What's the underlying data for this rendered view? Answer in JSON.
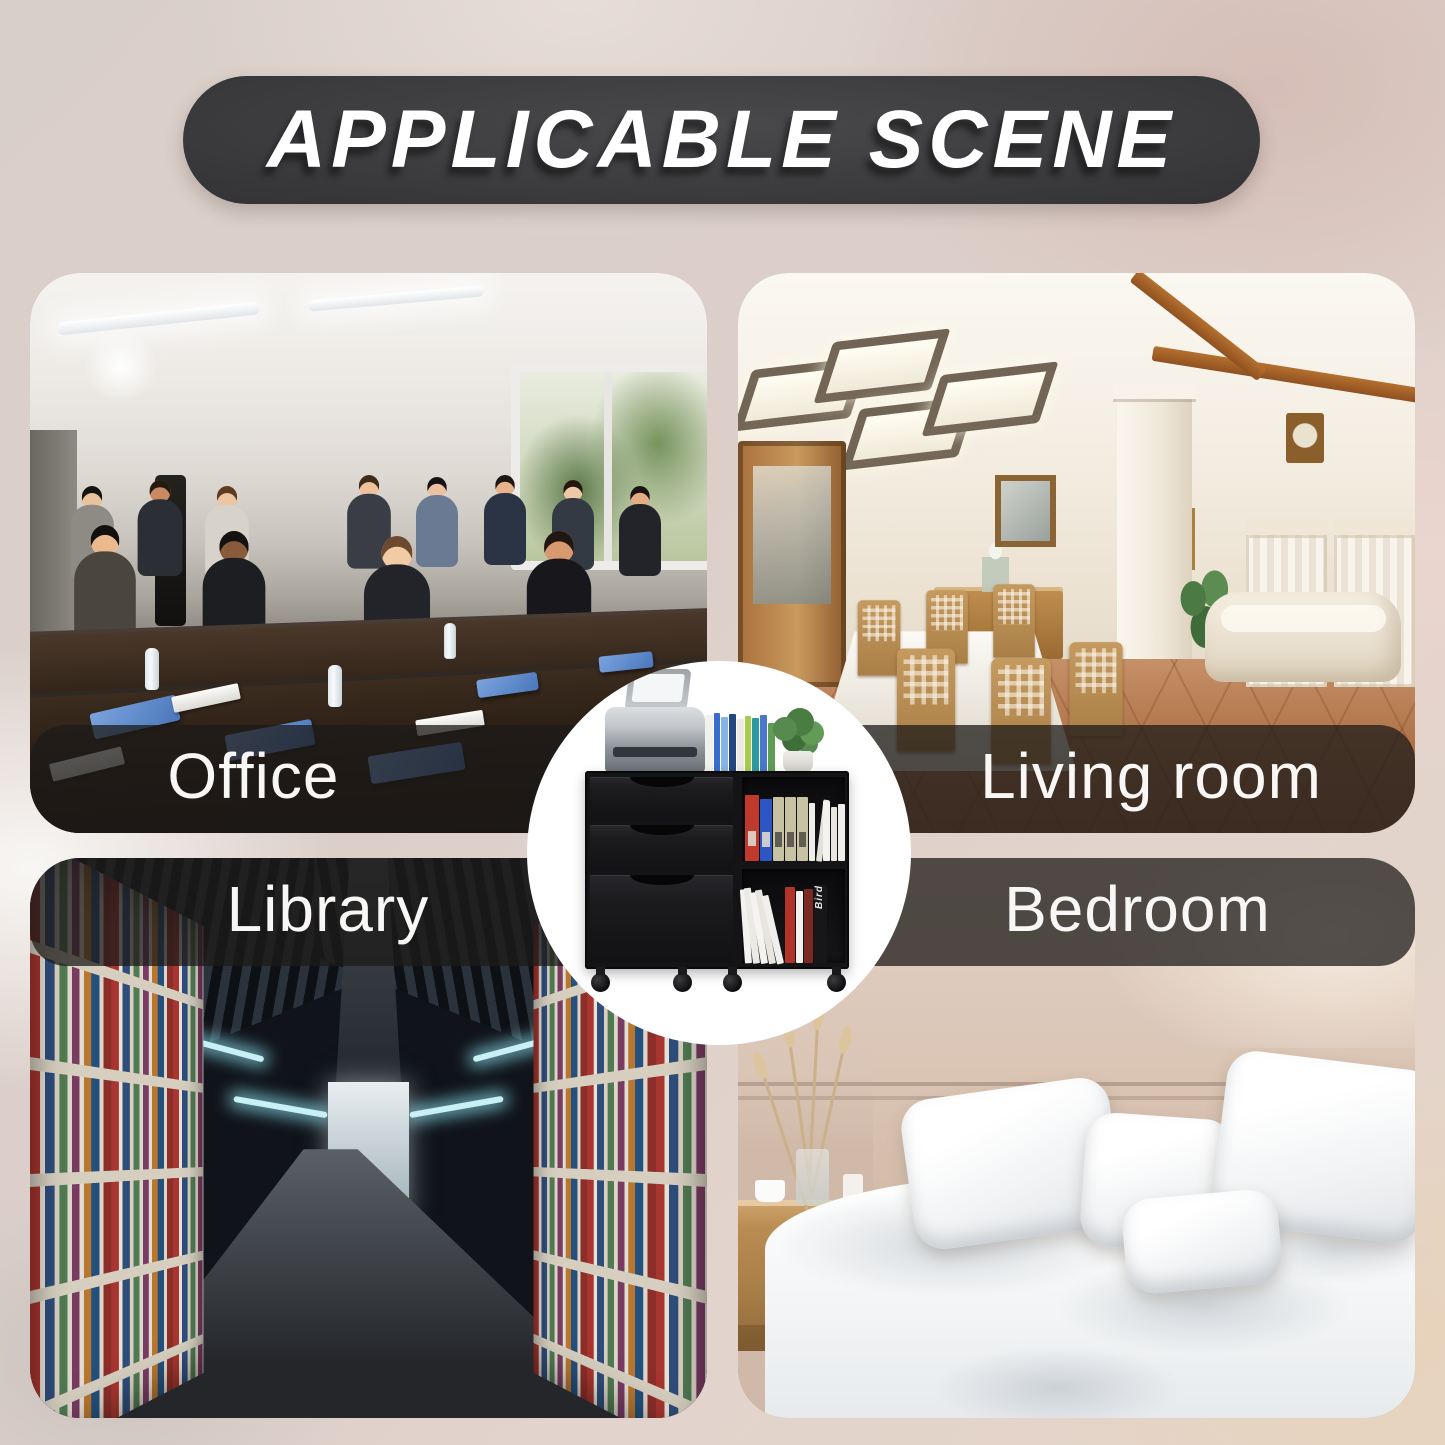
{
  "header": {
    "title": "APPLICABLE SCENE"
  },
  "scenes": {
    "office": {
      "label": "Office",
      "position": "top-left",
      "label_side": "bottom"
    },
    "living_room": {
      "label": "Living room",
      "position": "top-right",
      "label_side": "bottom"
    },
    "library": {
      "label": "Library",
      "position": "bottom-left",
      "label_side": "top"
    },
    "bedroom": {
      "label": "Bedroom",
      "position": "bottom-right",
      "label_side": "top"
    }
  },
  "product_badge": {
    "shape": "circle",
    "depicts": "black mobile file cabinet with 3 drawers, open shelves holding binders and books, printer and small plant on top, caster wheels",
    "book_spine_text": "Bird"
  },
  "colors": {
    "page_background": "#d9cfc9",
    "header_pill": "#353537",
    "header_text": "#ffffff",
    "label_strip": "rgba(30,27,25,0.75)",
    "label_text": "#f8f7f5",
    "badge_background": "#ffffff",
    "cabinet_body": "#141416",
    "binder_red": "#bf3a2d",
    "binder_blue": "#2e55c4",
    "binder_beige": "#c7c2a3",
    "plant_green": "#578a4e",
    "printer_gray": "#c3c6c9"
  }
}
